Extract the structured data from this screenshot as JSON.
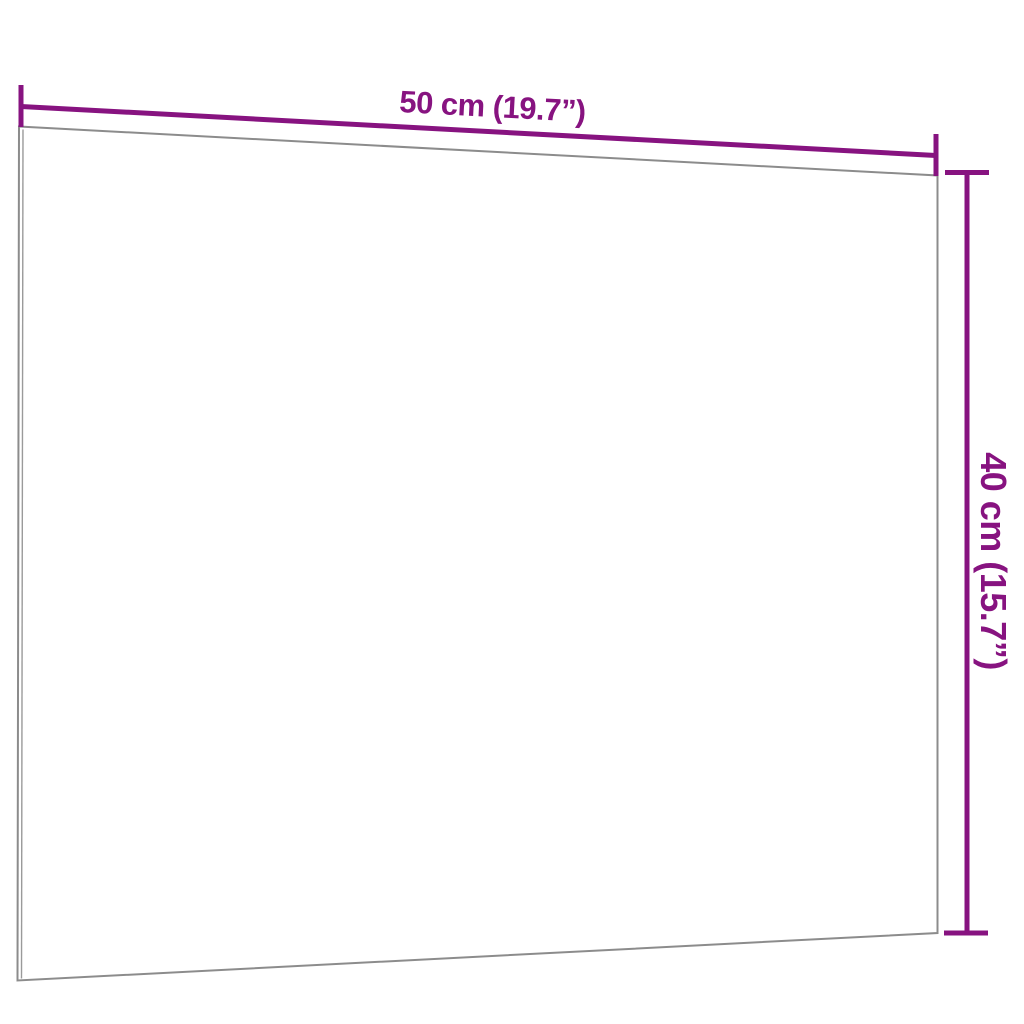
{
  "diagram": {
    "description": "Wall-mounted white board product dimension diagram",
    "width_label": "50 cm (19.7”)",
    "height_label": "40 cm (15.7”)"
  },
  "colors": {
    "accent": "#871380",
    "outline": "#8c8c8c",
    "edge_inner": "#9a9a9a",
    "board_fill": "#ffffff",
    "background": "#ffffff"
  }
}
